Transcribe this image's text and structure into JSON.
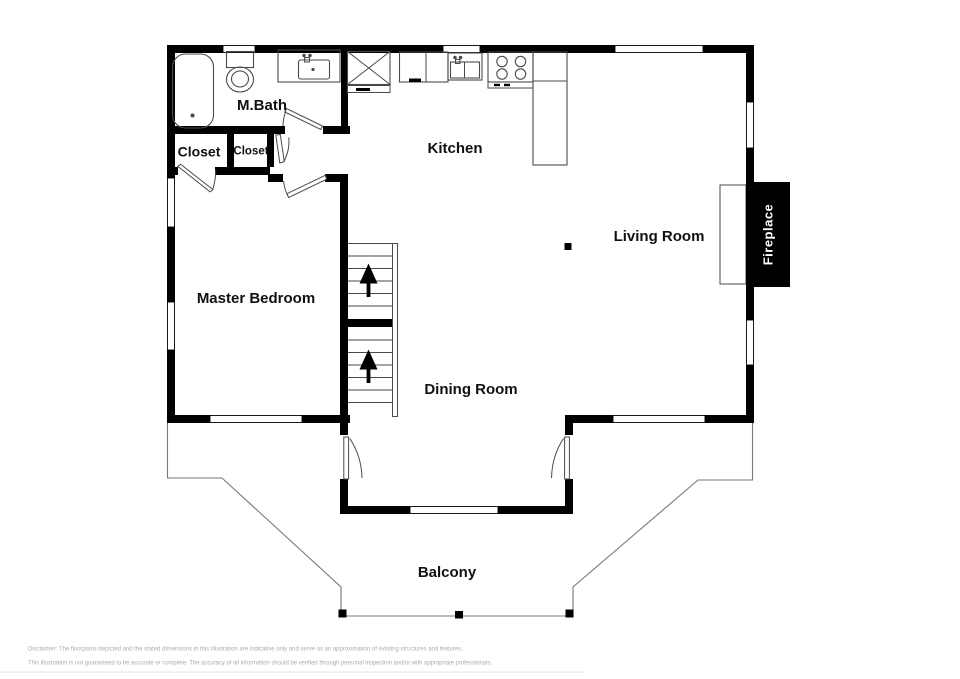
{
  "plan": {
    "labels": {
      "mbath": "M.Bath",
      "closet_large": "Closet",
      "closet_small": "Closet",
      "kitchen": "Kitchen",
      "living_room": "Living Room",
      "master_bedroom": "Master Bedroom",
      "dining_room": "Dining Room",
      "balcony": "Balcony",
      "fireplace": "Fireplace"
    },
    "features": [
      "bathtub",
      "toilet",
      "vanity-sink",
      "refrigerator",
      "kitchen-sink",
      "stove-4-burners",
      "island-counter",
      "stairs-up-two-runs",
      "fireplace-with-hearth",
      "balcony-railing-with-posts",
      "windows",
      "door-swings"
    ]
  },
  "disclaimer": {
    "line1": "Disclaimer: The floorplans depicted and the stated dimensions in this illustration are indicative only and serve as an approximation of existing structures and features.",
    "line2": "This illustration is not guaranteed to be accurate or complete. The accuracy of all information should be verified through personal inspection and/or with appropriate professionals."
  },
  "colors": {
    "walls": "#000000",
    "background": "#ffffff",
    "fireplace_bg": "#000000",
    "fireplace_text": "#ffffff",
    "disclaimer_text": "#a6adb8",
    "thin_lines": "#4a4a4a"
  }
}
